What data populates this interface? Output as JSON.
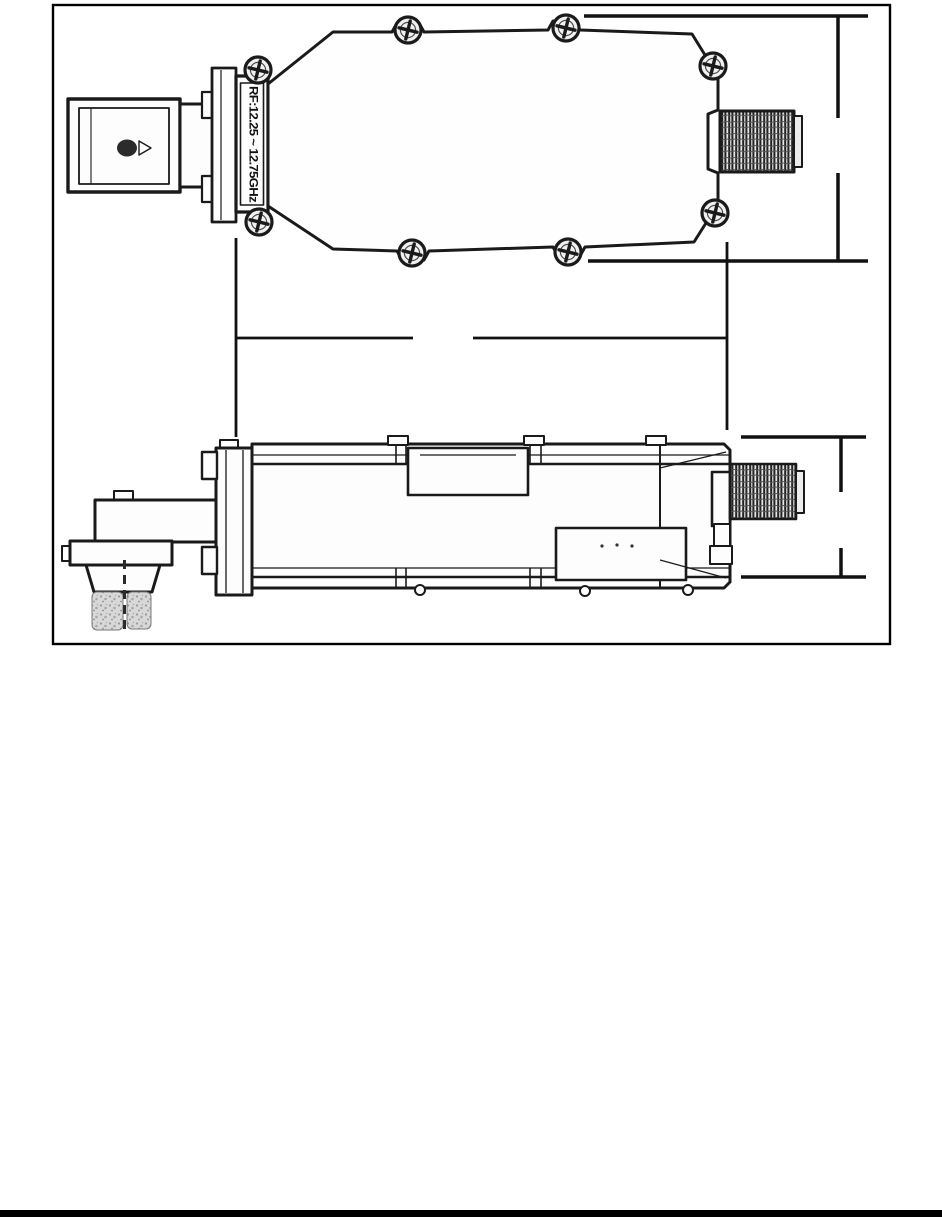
{
  "figure": {
    "device_label": "RF:12.25 ~ 12.75GHz",
    "colors": {
      "paper": "#ffffff",
      "frame": "#000000",
      "ink": "#1a1a1a",
      "thread_shade": "#555555",
      "stipple_fill": "#d8d8d8"
    },
    "views": {
      "top_view": "lnb-top-view",
      "side_view": "lnb-side-view"
    }
  },
  "footer": {
    "rule_color": "#000000"
  }
}
